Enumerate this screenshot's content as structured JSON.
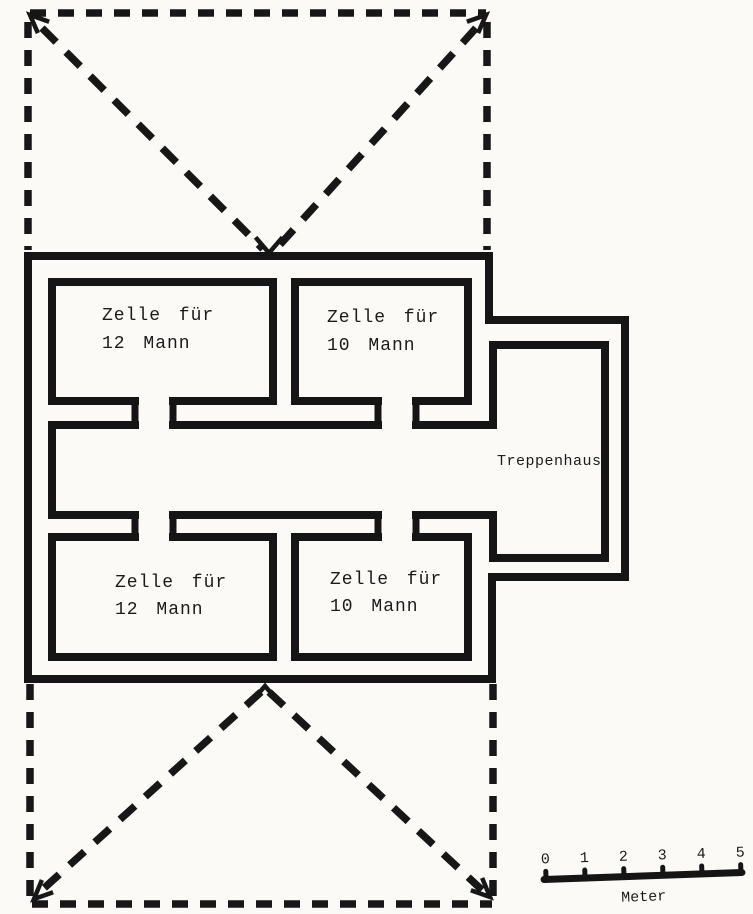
{
  "diagram": {
    "type": "scanned-floor-plan",
    "cells": [
      {
        "name": "cell-top-left",
        "line1": "Zelle für",
        "line2": "12 Mann"
      },
      {
        "name": "cell-top-right",
        "line1": "Zelle für",
        "line2": "10 Mann"
      },
      {
        "name": "cell-bottom-left",
        "line1": "Zelle für",
        "line2": "12 Mann"
      },
      {
        "name": "cell-bottom-right",
        "line1": "Zelle für",
        "line2": "10 Mann"
      }
    ],
    "stairwell_label": "Treppenhaus",
    "scale_bar": {
      "ticks": [
        "0",
        "1",
        "2",
        "3",
        "4",
        "5"
      ],
      "unit_label": "Meter"
    },
    "colors": {
      "ink": "#151515",
      "paper": "#fbfaf6"
    }
  }
}
